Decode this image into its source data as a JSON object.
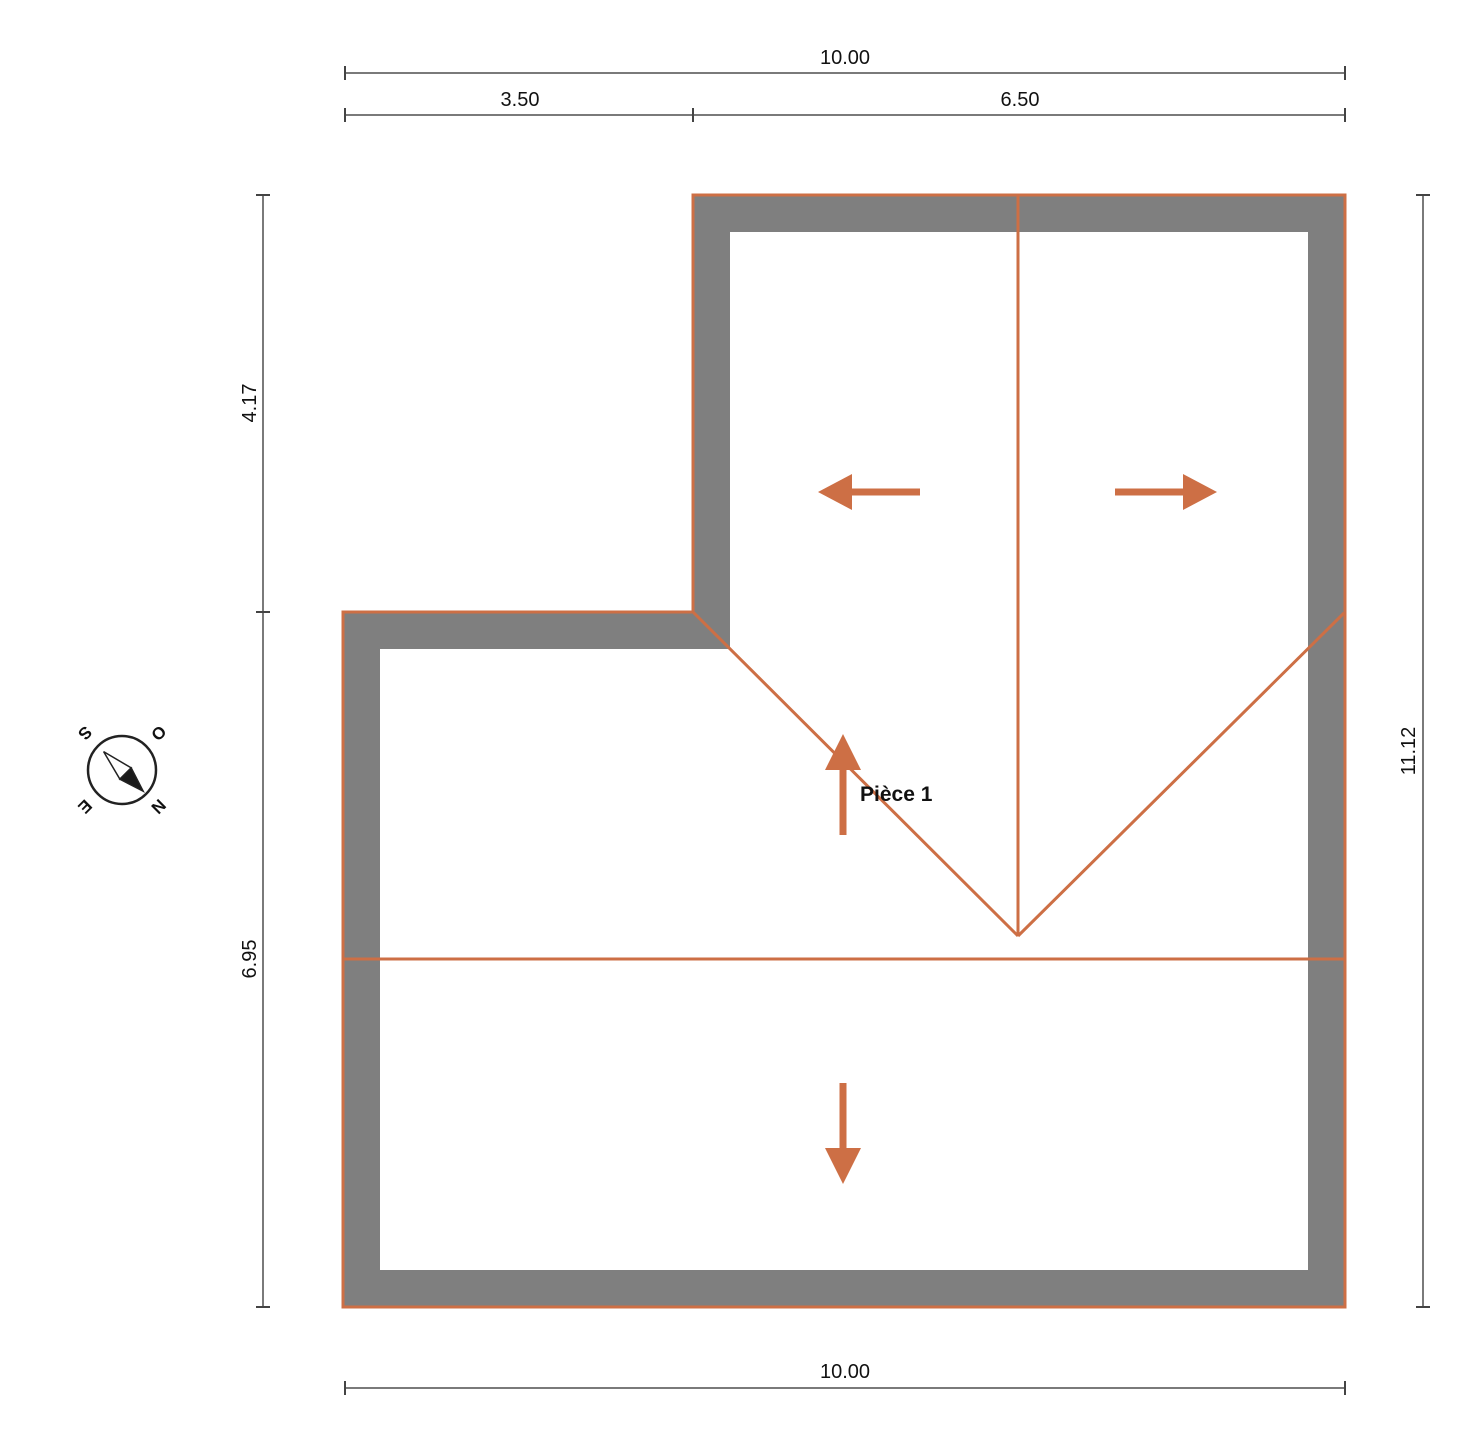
{
  "plan": {
    "room_label": "Pièce 1"
  },
  "dimensions": {
    "top_total": "10.00",
    "top_segment_left": "3.50",
    "top_segment_right": "6.50",
    "left_upper": "4.17",
    "left_lower": "6.95",
    "right_total": "11.12",
    "bottom_total": "10.00"
  },
  "compass": {
    "north": "N",
    "south": "S",
    "east": "E",
    "west": "O"
  },
  "colors": {
    "roof_line_orange": "#cd6f45",
    "wall_fill_gray": "#7f7f7f",
    "dimension_line_gray": "#7a7a7a",
    "label_text": "#111111"
  }
}
